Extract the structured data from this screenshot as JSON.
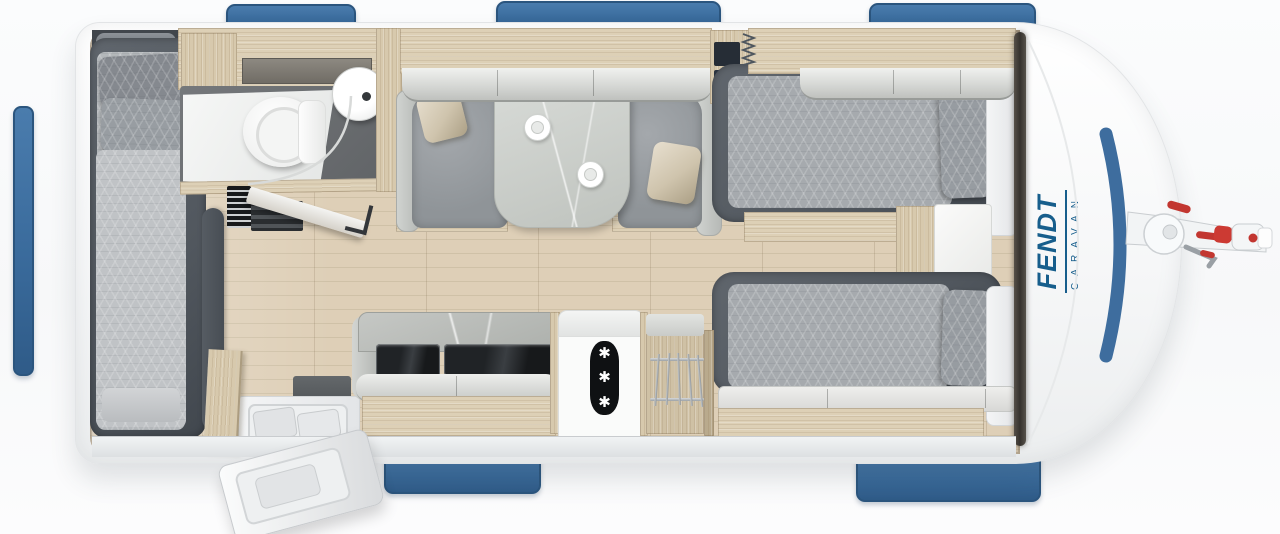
{
  "scene": {
    "description": "Fendt caravan floor plan, top view product render",
    "width_px": 1280,
    "height_px": 534
  },
  "brand": {
    "name": "FENDT",
    "subtitle": "CARAVAN",
    "text_color": "#175e8c"
  },
  "fridge": {
    "freezer_symbol": "✱",
    "symbols_shown": 3
  },
  "palette": {
    "window_blue": "#3f6f9f",
    "nose_stripe_blue": "#3e6d9e",
    "hitch_red": "#c23630",
    "body_white": "#ffffff",
    "floor_wood": "#d9ccb4",
    "cabinet_wood": "#ddd0b6",
    "upholstery_gray": "#9b9fa4",
    "bed_frame_gray": "#575d64",
    "freezer_black": "#0f1113"
  }
}
